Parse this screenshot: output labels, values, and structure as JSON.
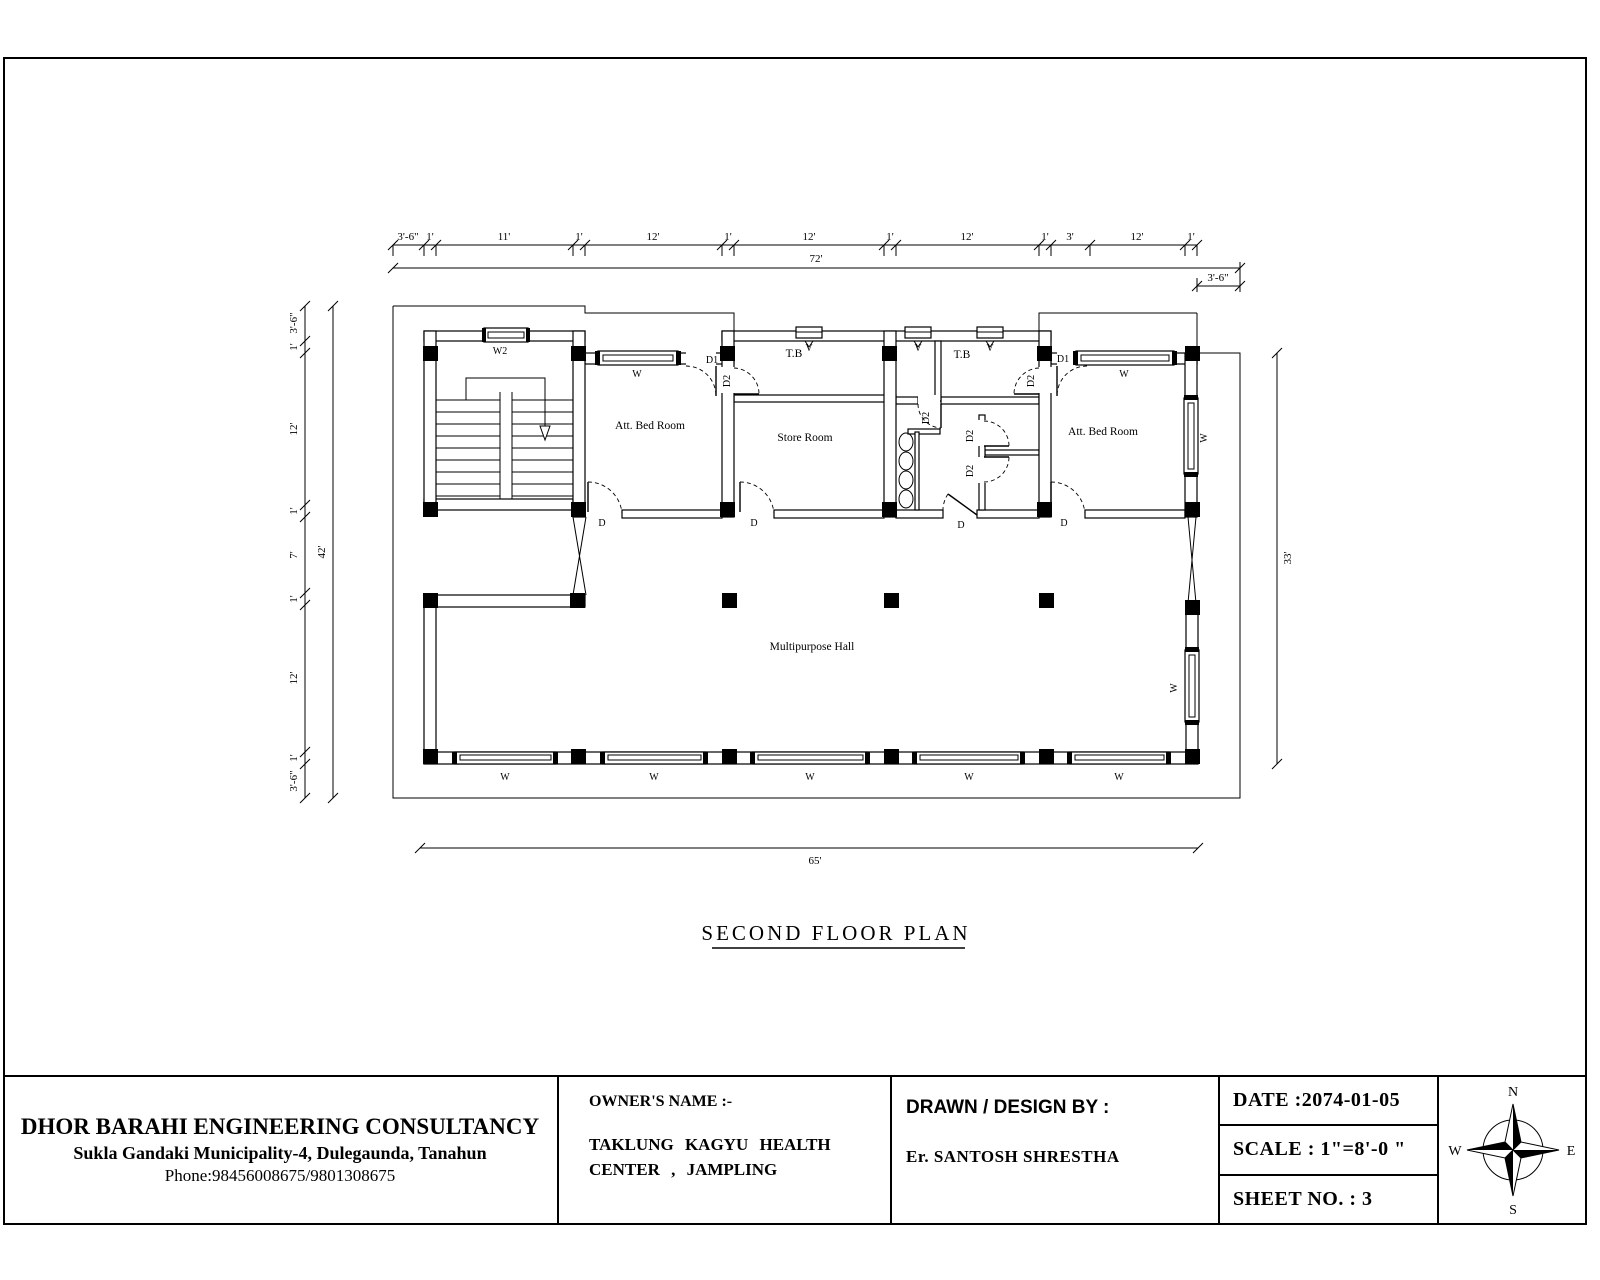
{
  "plan": {
    "title": "SECOND FLOOR PLAN",
    "rooms": {
      "att_bed_room": "Att. Bed Room",
      "store_room": "Store Room",
      "tb": "T.B",
      "multipurpose_hall": "Multipurpose Hall"
    },
    "openings": {
      "window": "W",
      "window2": "W2",
      "door": "D",
      "door1": "D1",
      "door2": "D2",
      "vent": "V"
    },
    "dimensions": {
      "top_segments": [
        "3'-6\"",
        "1'",
        "11'",
        "1'",
        "12'",
        "1'",
        "12'",
        "1'",
        "12'",
        "1'",
        "3'",
        "12'",
        "1'"
      ],
      "top_total": "72'",
      "top_right_offset": "3'-6\"",
      "left_segments": [
        "3'-6\"",
        "1'",
        "12'",
        "1'",
        "7'",
        "1'",
        "12'",
        "1'",
        "3'-6\""
      ],
      "left_total": "42'",
      "right_total": "33'",
      "bottom_total": "65'"
    }
  },
  "title_block": {
    "company": "DHOR BARAHI ENGINEERING CONSULTANCY",
    "address": "Sukla Gandaki Municipality-4, Dulegaunda, Tanahun",
    "phone": "Phone:98456008675/9801308675",
    "owner_label": "OWNER'S NAME :-",
    "owner_line1": "TAKLUNG KAGYU HEALTH",
    "owner_line2": "CENTER , JAMPLING",
    "drawn_label": "DRAWN / DESIGN BY :",
    "drawn_name": "Er. SANTOSH SHRESTHA",
    "date": "DATE :2074-01-05",
    "scale": "SCALE :  1\"=8'-0 \"",
    "sheet": "SHEET NO. : 3",
    "compass": {
      "n": "N",
      "e": "E",
      "s": "S",
      "w": "W"
    }
  }
}
